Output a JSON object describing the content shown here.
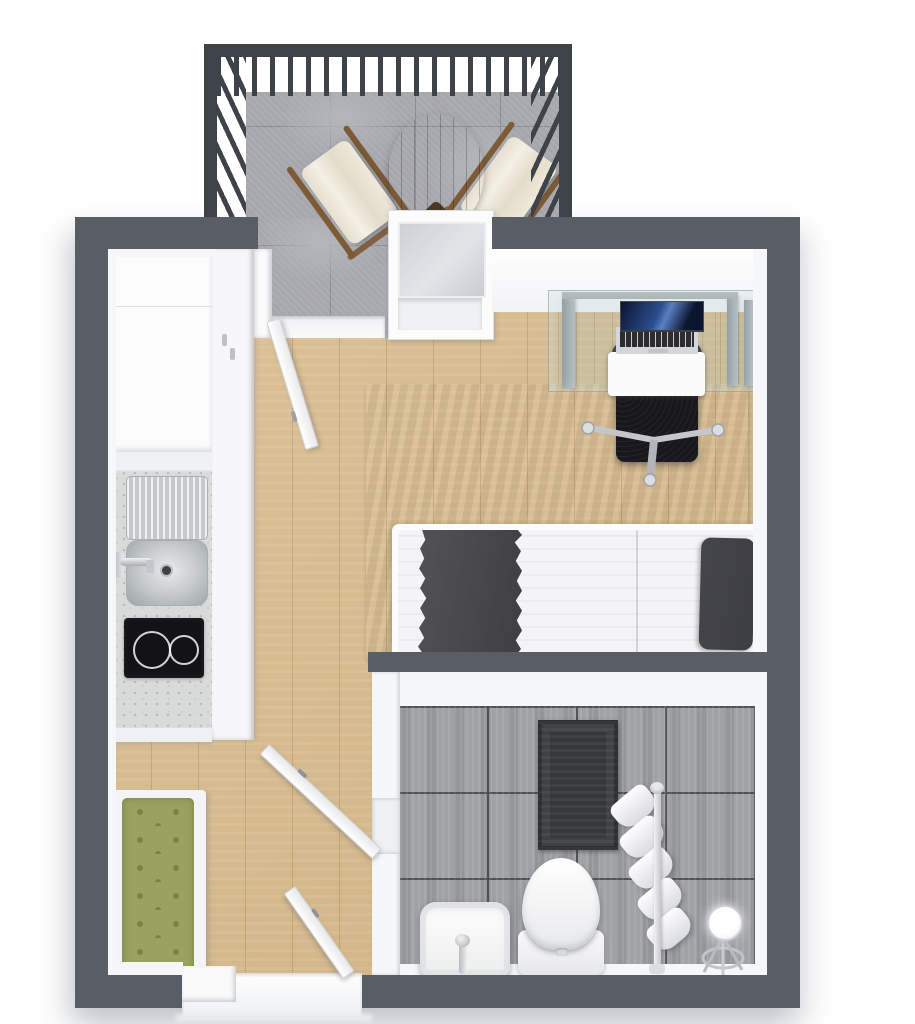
{
  "meta": {
    "type": "3d-floorplan-render",
    "description": "Top-down 3D rendered floor plan of a studio apartment with balcony, kitchenette, sleeping area, bathroom and entry"
  },
  "palette": {
    "wall": "#585d66",
    "lining": "#f6f7f8",
    "white": "#fcfcfd",
    "wood": "#d9bc8e",
    "balconyTile": "#a6a7ac",
    "balconyTileLight": "#b5b6bb",
    "railing": "#3e434a",
    "rug": "#4f6c6f",
    "rugDark": "#43595e",
    "counter": "#d9dbda",
    "counterSpeck": "#b7bcb8",
    "cooktop": "#131317",
    "bench": "#99a260",
    "benchDot": "#79843f",
    "bathTile": "#a0a2a5",
    "bathGrout": "#515357",
    "mat": "#35383a",
    "chairBlack": "#222227",
    "seatBlack": "#18181c",
    "tableWood": "#5d472c",
    "tableWoodDark": "#4b3922",
    "slingFabric": "#ece6d7",
    "slingWood": "#7c5b36",
    "screenBlue": "#2a4f8f",
    "screenDark": "#0b1530",
    "laptopBody": "#d5d6d9",
    "keys": "#2c2c31",
    "mattress": "#f4f4f6",
    "blanket": "#47474c",
    "pillow": "#3d3d44",
    "glass": "rgba(170,200,200,0.22)",
    "glassEdge": "rgba(130,155,160,0.55)",
    "chrome": "#c9cacf"
  },
  "rooms": [
    {
      "name": "balcony",
      "items": [
        "metal-railing",
        "stone-tile-floor",
        "round-wood-dining-table",
        "sling-chair-left",
        "sling-chair-right",
        "balcony-door-open",
        "window"
      ]
    },
    {
      "name": "studio-main-room",
      "items": [
        "oak-plank-floor",
        "white-wardrobe",
        "kitchenette-counter",
        "stainless-sink-with-drainboard",
        "two-burner-cooktop",
        "teal-area-rug",
        "glass-desk",
        "open-laptop",
        "black-office-chair",
        "single-bed-with-dark-throw-and-pillow",
        "green-tufted-bench"
      ]
    },
    {
      "name": "bathroom",
      "items": [
        "concrete-tile-floor",
        "dark-bath-mat",
        "washbasin",
        "toilet",
        "towel-stand-with-white-towels",
        "vanity-mirror-stand",
        "bathroom-door-open"
      ]
    },
    {
      "name": "entry",
      "items": [
        "entrance-door-open",
        "white-threshold"
      ]
    }
  ]
}
